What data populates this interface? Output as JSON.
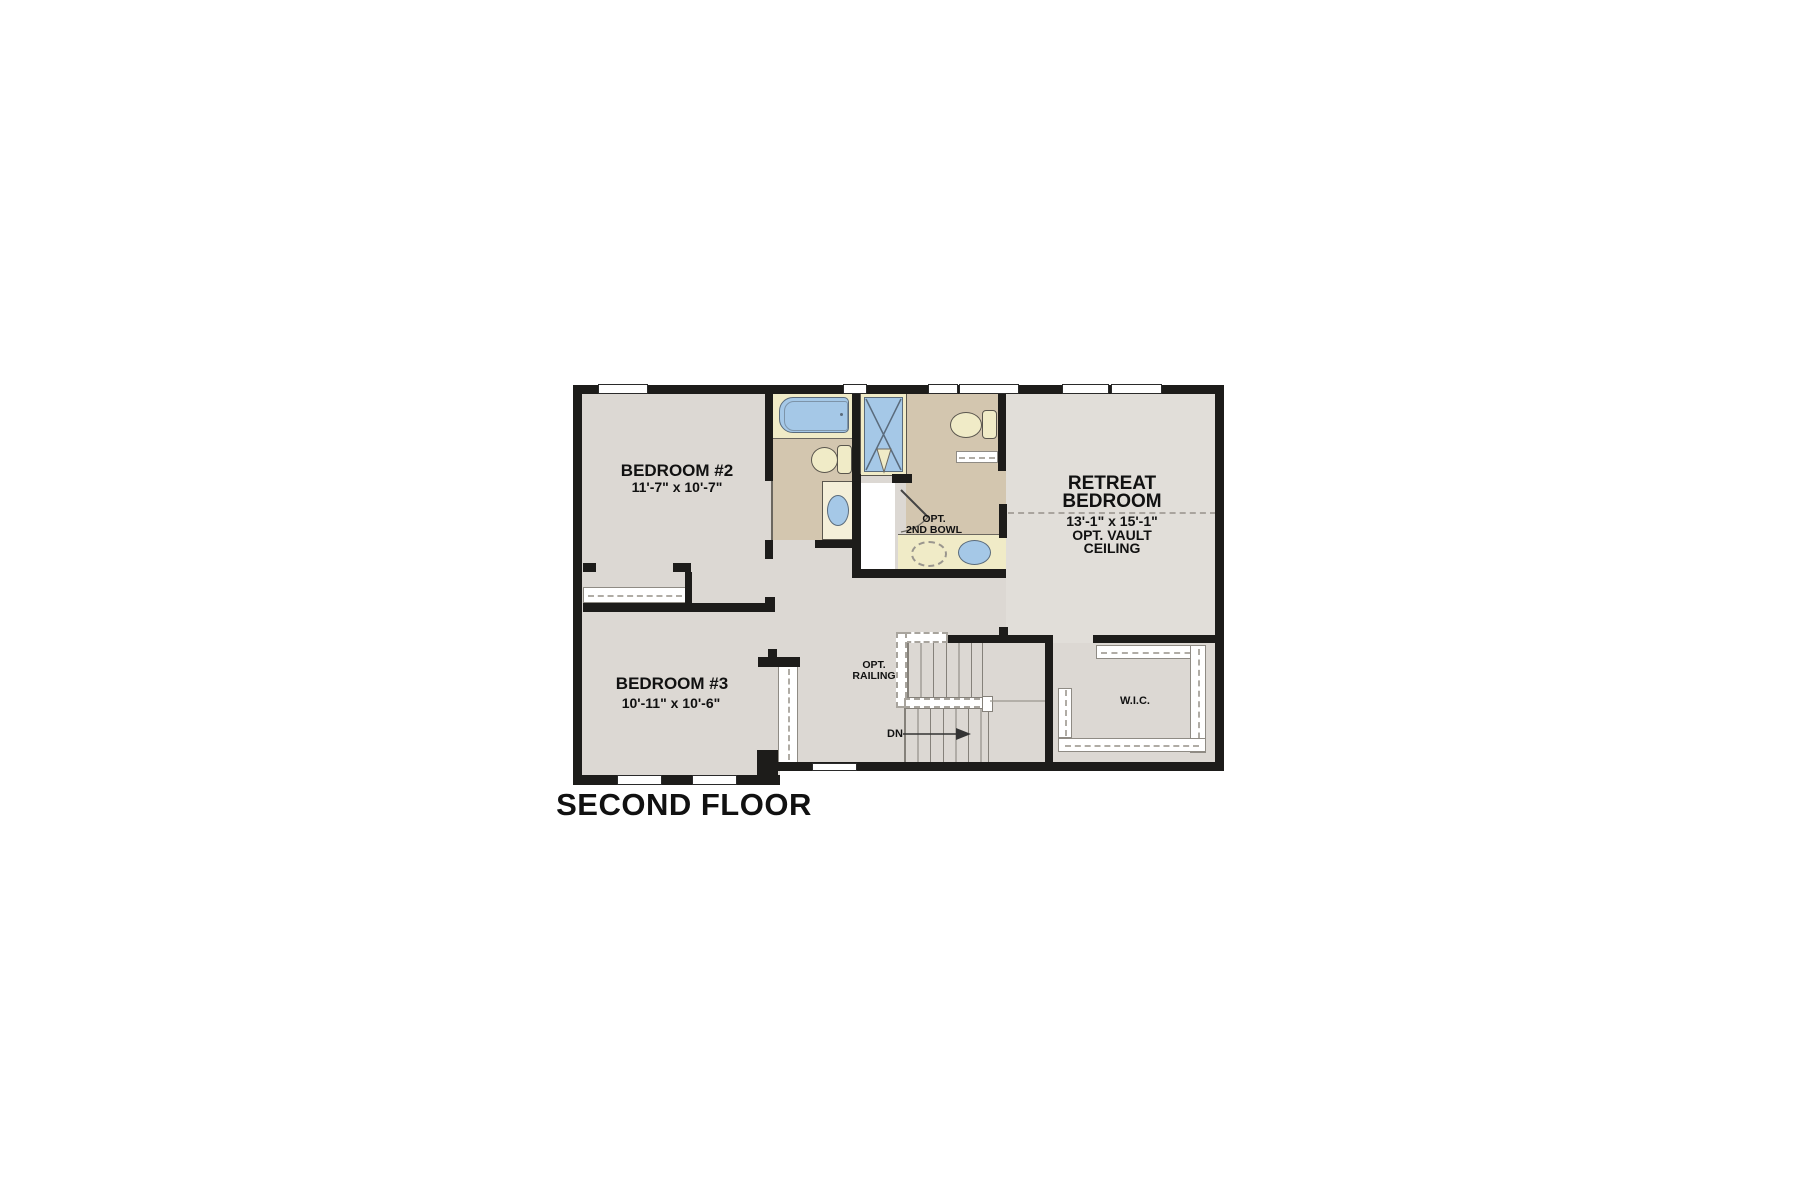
{
  "title": "SECOND FLOOR",
  "rooms": {
    "bedroom2": {
      "name": "BEDROOM #2",
      "dims": "11'-7\" x 10'-7\""
    },
    "bedroom3": {
      "name": "BEDROOM #3",
      "dims": "10'-11\" x 10'-6\""
    },
    "retreat": {
      "name_line1": "RETREAT",
      "name_line2": "BEDROOM",
      "dims": "13'-1\" x 15'-1\"",
      "option_line1": "OPT. VAULT",
      "option_line2": "CEILING"
    },
    "wic": {
      "name": "W.I.C."
    }
  },
  "annotations": {
    "opt_railing_line1": "OPT.",
    "opt_railing_line2": "RAILING",
    "down_label": "DN",
    "opt_2nd_bowl_line1": "OPT.",
    "opt_2nd_bowl_line2": "2ND BOWL"
  },
  "colors": {
    "wall": "#1d1c1a",
    "floor": "#dcd8d3",
    "floor_light": "#e1ded9",
    "bath_floor": "#d3c6af",
    "fixture_yellow": "#f0ebc7",
    "fixture_blue": "#a5c8e7",
    "text": "#111111"
  }
}
